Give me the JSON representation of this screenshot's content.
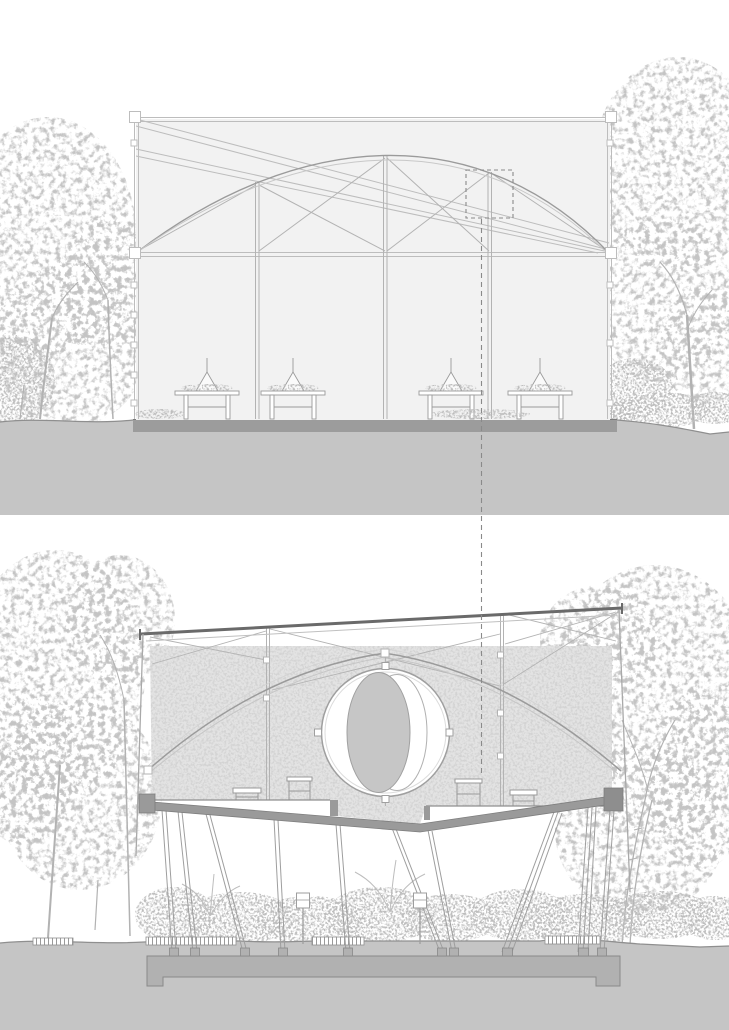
{
  "figure": {
    "kind": "architectural section drawing pair, grayscale line work with sketched trees",
    "panels": [
      {
        "name": "upper-section",
        "tables_with_lamps": 4,
        "interior_columns": 3,
        "has_arched_truss": true,
        "has_detail_callout_box": true,
        "trees": "sketched clusters left and right"
      },
      {
        "name": "lower-section",
        "has_circular_opening": true,
        "benches": 2,
        "tables": 2,
        "raking_pilotis": true,
        "garden_lamps": 2,
        "boardwalk_segments": 4,
        "trees": "sketched clusters left and right with undergrowth"
      }
    ],
    "connector": "vertical dashed reference line from detail box down into lower section"
  },
  "colors": {
    "ground": "#c5c5c5",
    "ground_line": "#8f8f8f",
    "floor_strip": "#9c9c9c",
    "wall_upper": "#f2f2f2",
    "wall_lower": "#e3e3e3",
    "frame_line": "#bdbdbd",
    "truss_line": "#b3b3b3",
    "arch_line": "#9b9b9b",
    "dark_line": "#6a6a6a",
    "slab": "#9a9a9a",
    "slab_edge": "#7e7e7e",
    "foundation": "#b1b1b1",
    "foundation_edge": "#898989",
    "circle_stroke": "#9f9f9f",
    "ellipse_fill": "#c6c6c6",
    "dashed": "#8a8a8a",
    "furniture": "#9a9a9a",
    "piloti": "#9e9e9e",
    "trunk": "#b2b2b2"
  }
}
